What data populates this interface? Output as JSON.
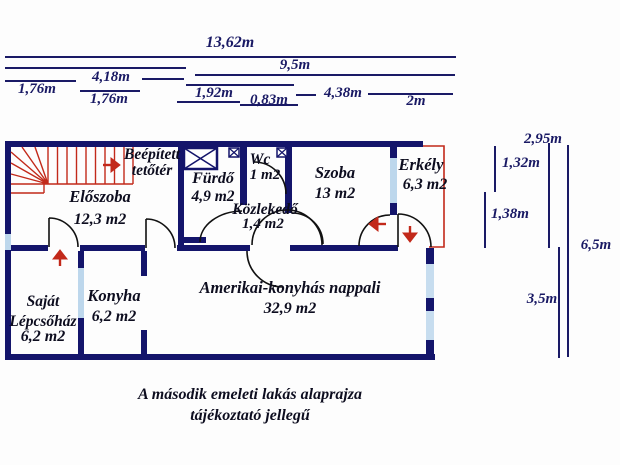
{
  "plan": {
    "title_hint": "floor-plan",
    "rooms": {
      "tetoter": {
        "name": "Beépített tetőtér",
        "area": ""
      },
      "eloszoba": {
        "name": "Előszoba",
        "area": "12,3 m2"
      },
      "furdo": {
        "name": "Fürdő",
        "area": "4,9 m2"
      },
      "wc": {
        "name": "Wc",
        "area": "1 m2"
      },
      "kozlekedo": {
        "name": "Közlekedő",
        "area": "1,4 m2"
      },
      "szoba": {
        "name": "Szoba",
        "area": "13 m2"
      },
      "erkely": {
        "name": "Erkély",
        "area": "6,3 m2"
      },
      "lepcsohaz": {
        "name": "Saját Lépcsőház",
        "area": "6,2 m2"
      },
      "konyha": {
        "name": "Konyha",
        "area": "6,2 m2"
      },
      "nappali": {
        "name": "Amerikai-konyhás nappali",
        "area": "32,9 m2"
      }
    }
  },
  "dimensions": {
    "top": {
      "d1362": "13,62m",
      "d95": "9,5m",
      "d418": "4,18m",
      "d176a": "1,76m",
      "d176b": "1,76m",
      "d192": "1,92m",
      "d083": "0,83m",
      "d438": "4,38m",
      "d2": "2m"
    },
    "right": {
      "d295": "2,95m",
      "d132": "1,32m",
      "d138": "1,38m",
      "d65": "6,5m",
      "d35": "3,5m"
    }
  },
  "caption": {
    "line1": "A második emeleti lakás alaprajza",
    "line2": "tájékoztató jellegű"
  },
  "colors": {
    "wall": "#14156b",
    "window": "#bdd7ec",
    "accent_red": "#c2291a",
    "dimension_line": "#1a1a66",
    "label_text": "#0d0d1f",
    "background": "#fdfdfd"
  }
}
